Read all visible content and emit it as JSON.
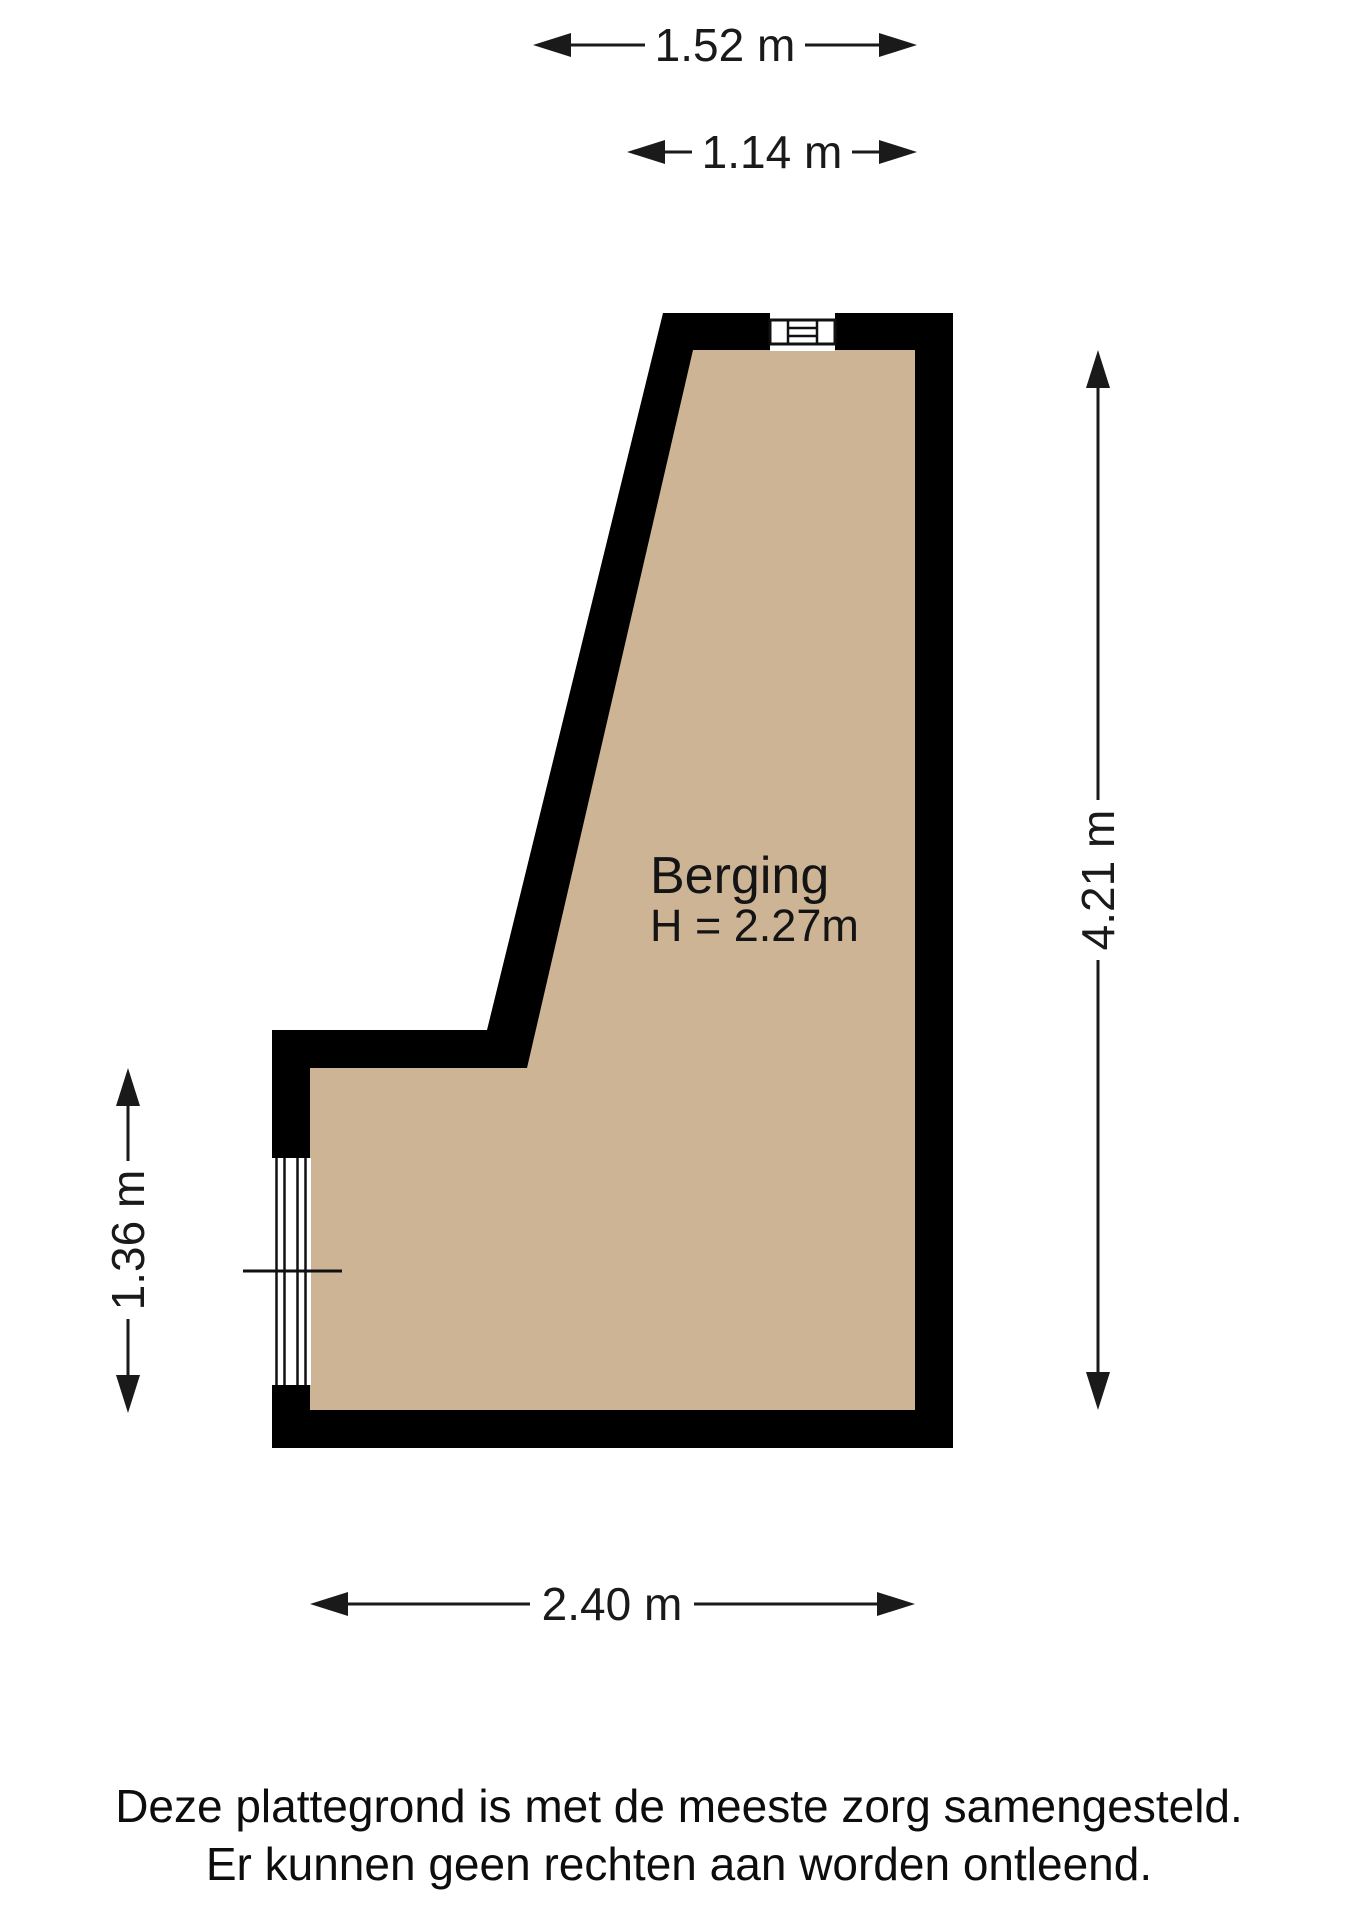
{
  "page": {
    "background_color": "#ffffff"
  },
  "floorplan": {
    "room": {
      "name": "Berging",
      "ceiling_height_label": "H = 2.27m"
    },
    "colors": {
      "wall": "#000000",
      "floor": "#CCB495",
      "dimension_text": "#1a1a1a"
    },
    "features": {
      "top_window": "window-symbol",
      "left_window": "window-symbol"
    },
    "dimensions": {
      "top_outer": "1.52 m",
      "top_inner": "1.14 m",
      "right_side": "4.21 m",
      "left_side": "1.36 m",
      "bottom": "2.40 m"
    }
  },
  "footer": {
    "line1": "Deze plattegrond is met de meeste zorg samengesteld.",
    "line2": "Er kunnen geen rechten aan worden ontleend."
  }
}
